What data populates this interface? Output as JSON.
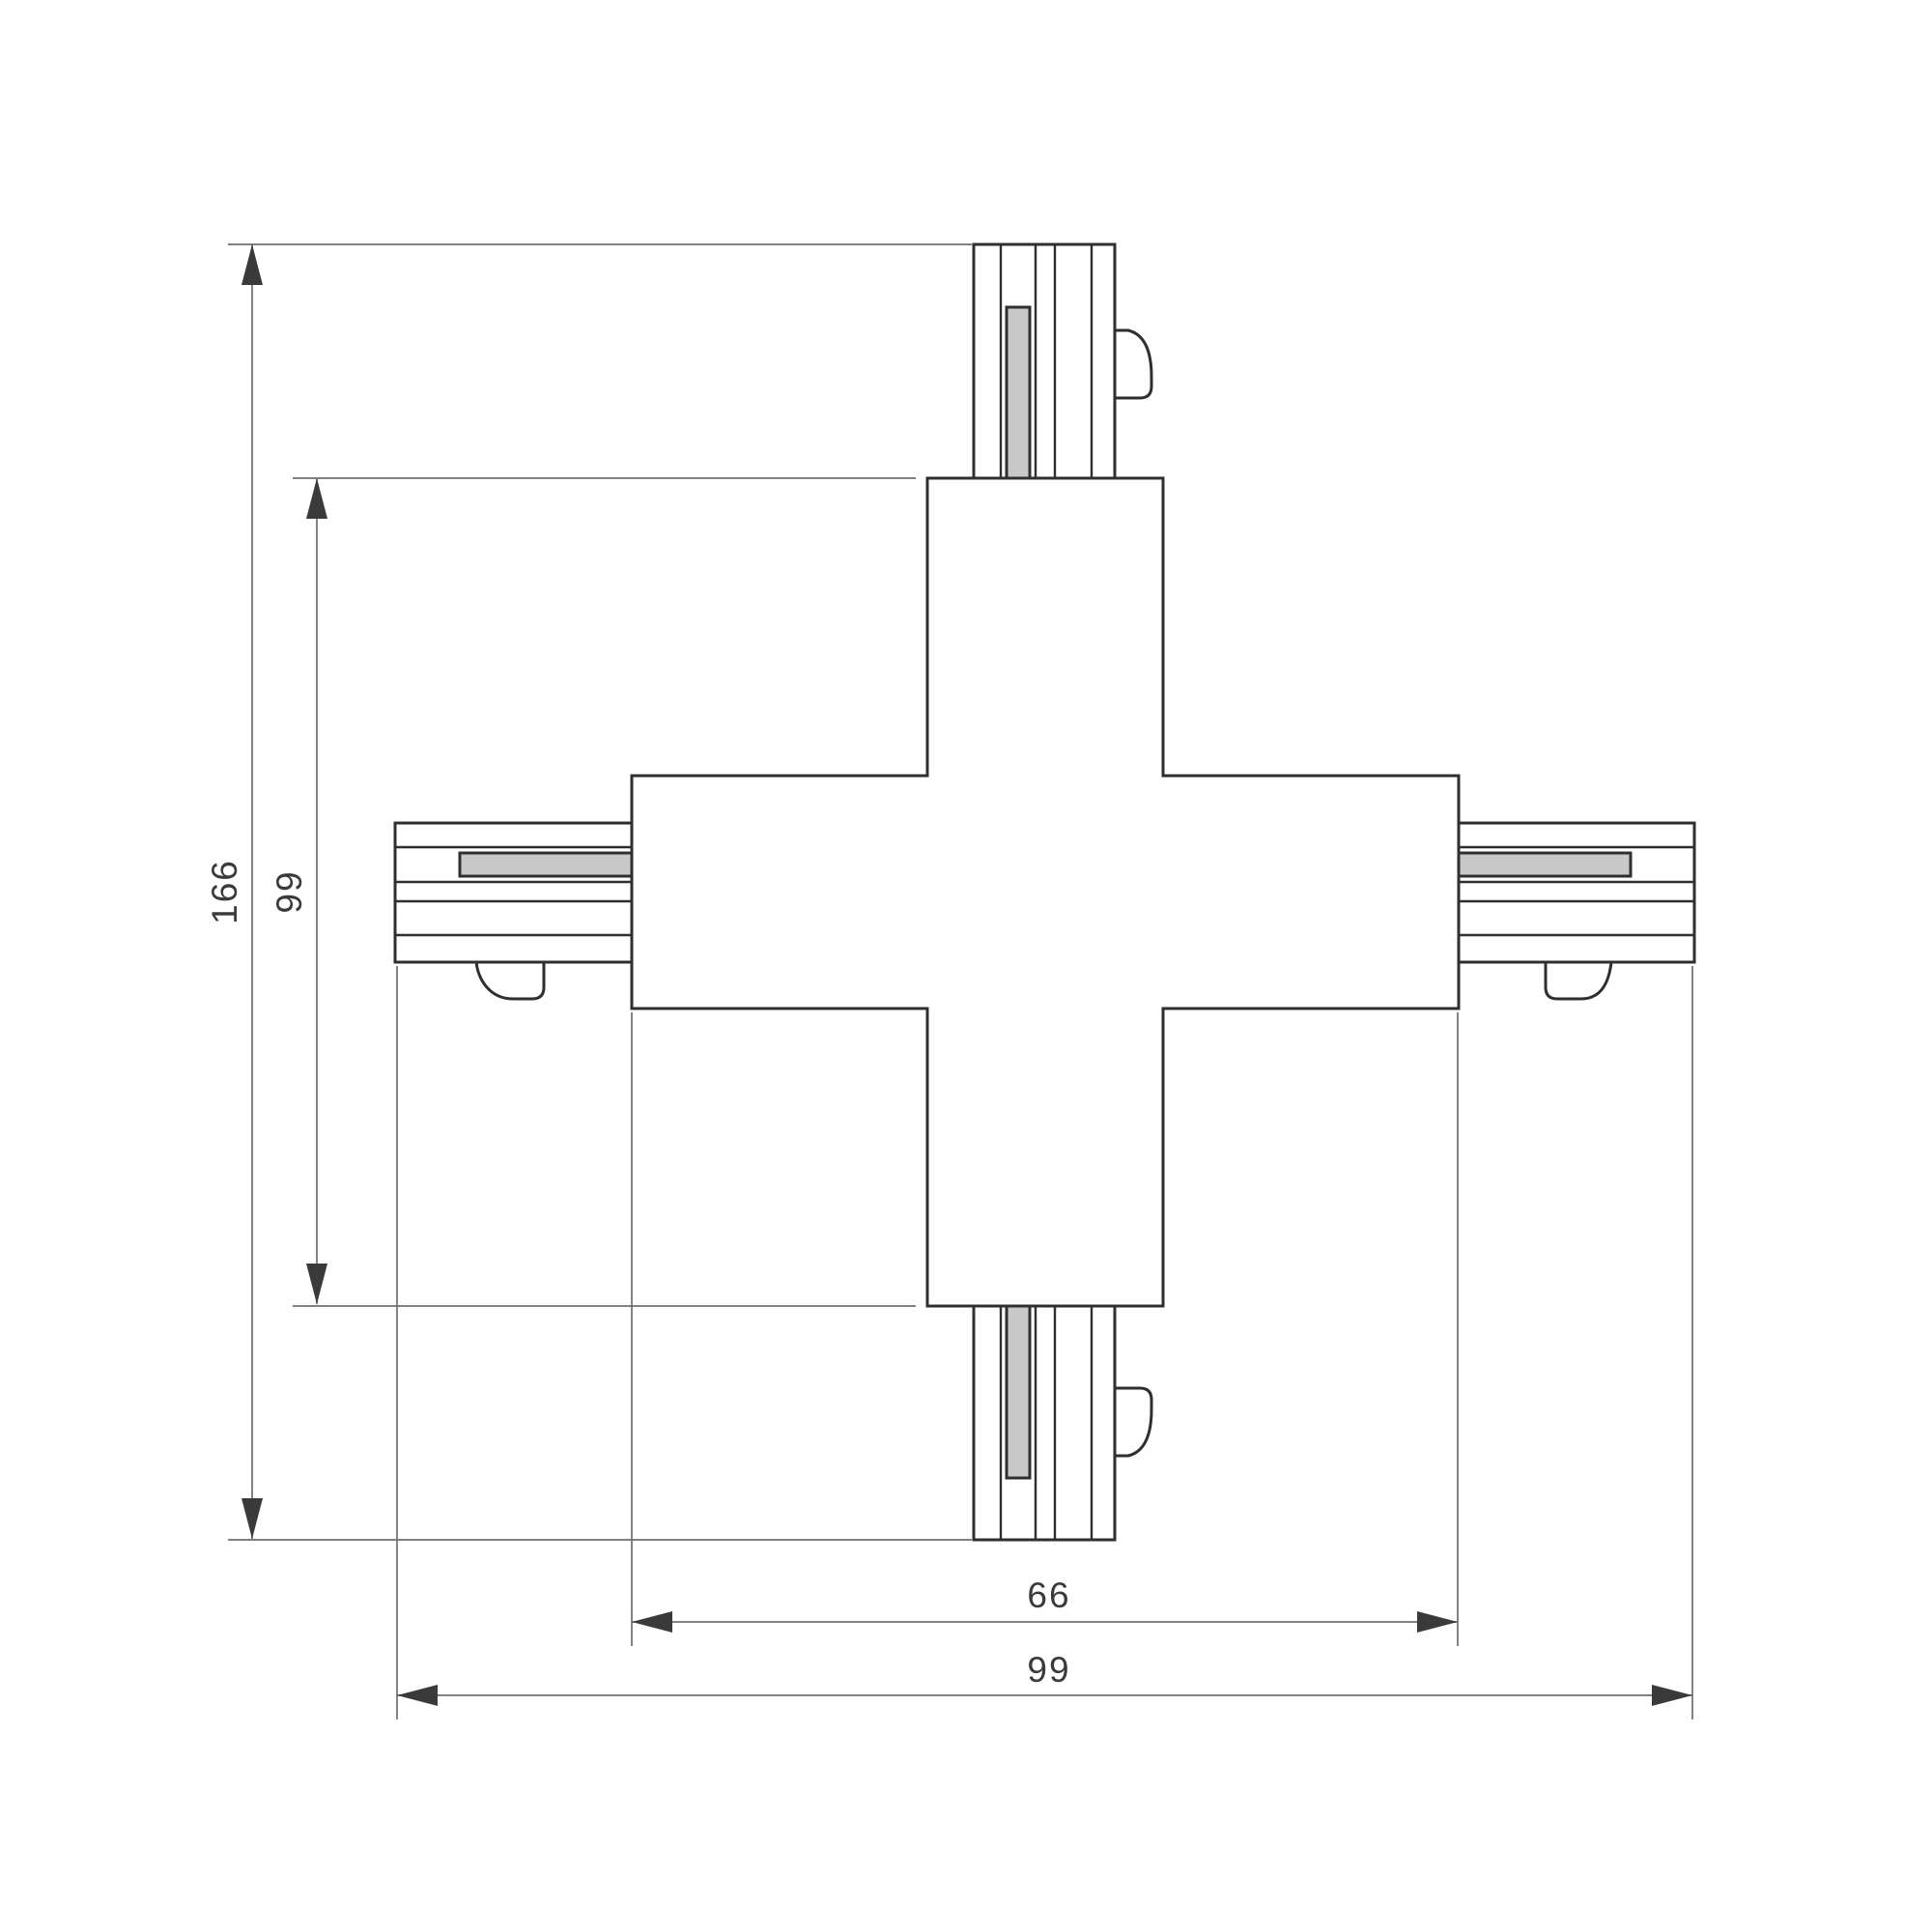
{
  "drawing": {
    "type": "technical-dimension-drawing",
    "subject": "four-way X track connector, plan view",
    "dimensions": {
      "total_height": "166",
      "body_height": "99",
      "body_width": "66",
      "total_width": "99"
    },
    "colors": {
      "background": "#ffffff",
      "object_line": "#2f2f2f",
      "dimension_line": "#6f6f6f",
      "dimension_text": "#3a3a3a",
      "arrow": "#3a3a3a",
      "conductor_bar_fill": "#c7c9c9"
    }
  }
}
